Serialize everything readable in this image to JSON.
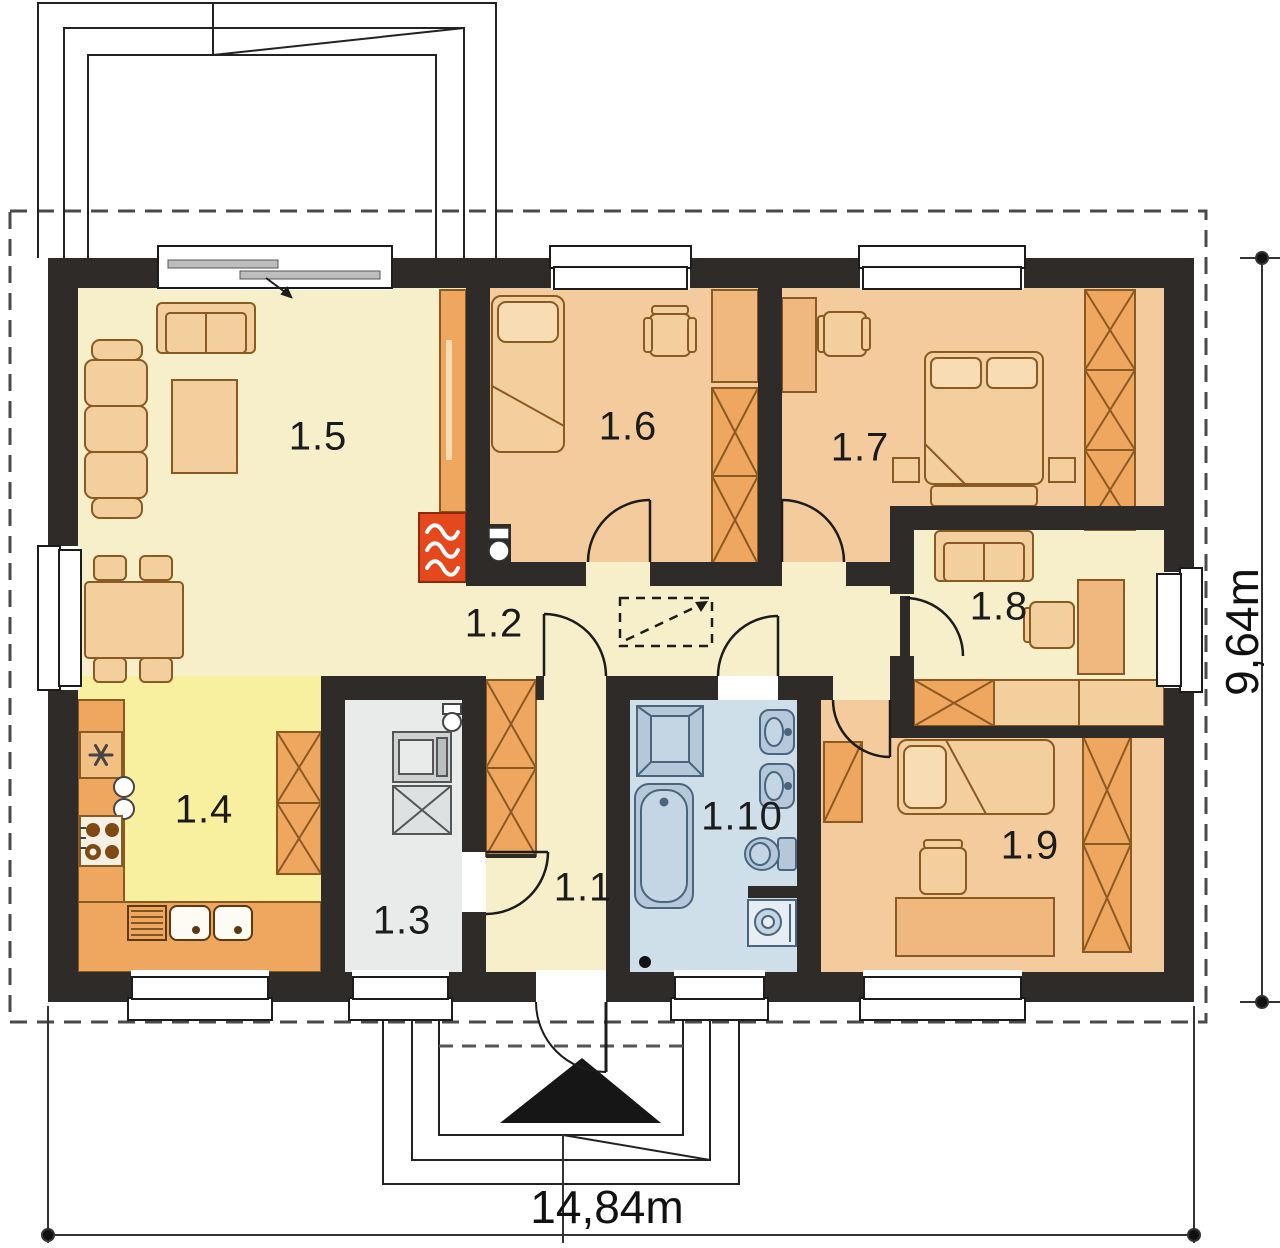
{
  "plan_title": "house-floor-plan",
  "rooms": {
    "r1_1": "1.1",
    "r1_2": "1.2",
    "r1_3": "1.3",
    "r1_4": "1.4",
    "r1_5": "1.5",
    "r1_6": "1.6",
    "r1_7": "1.7",
    "r1_8": "1.8",
    "r1_9": "1.9",
    "r1_10": "1.10"
  },
  "dimensions": {
    "width": "14,84m",
    "height": "9,64m"
  },
  "colors": {
    "wall": "#2f2b28",
    "outline": "#1c1c1c",
    "cream": "#f6efca",
    "peach": "#f3cb9d",
    "furn": "#f4cf9e",
    "furnLight": "#f7dcb4",
    "orange": "#efa75f",
    "desk": "#f0b87e",
    "yellow": "#f8ef9f",
    "grayRoom": "#e9ebeb",
    "grayEquip": "#ced2d2",
    "blueRoom": "#cfdfe9",
    "fixture": "#b4c8da",
    "fixtureStroke": "#4a667f",
    "red": "#e6481d",
    "furnStroke": "#8a5a23",
    "dimLine": "#333333"
  }
}
